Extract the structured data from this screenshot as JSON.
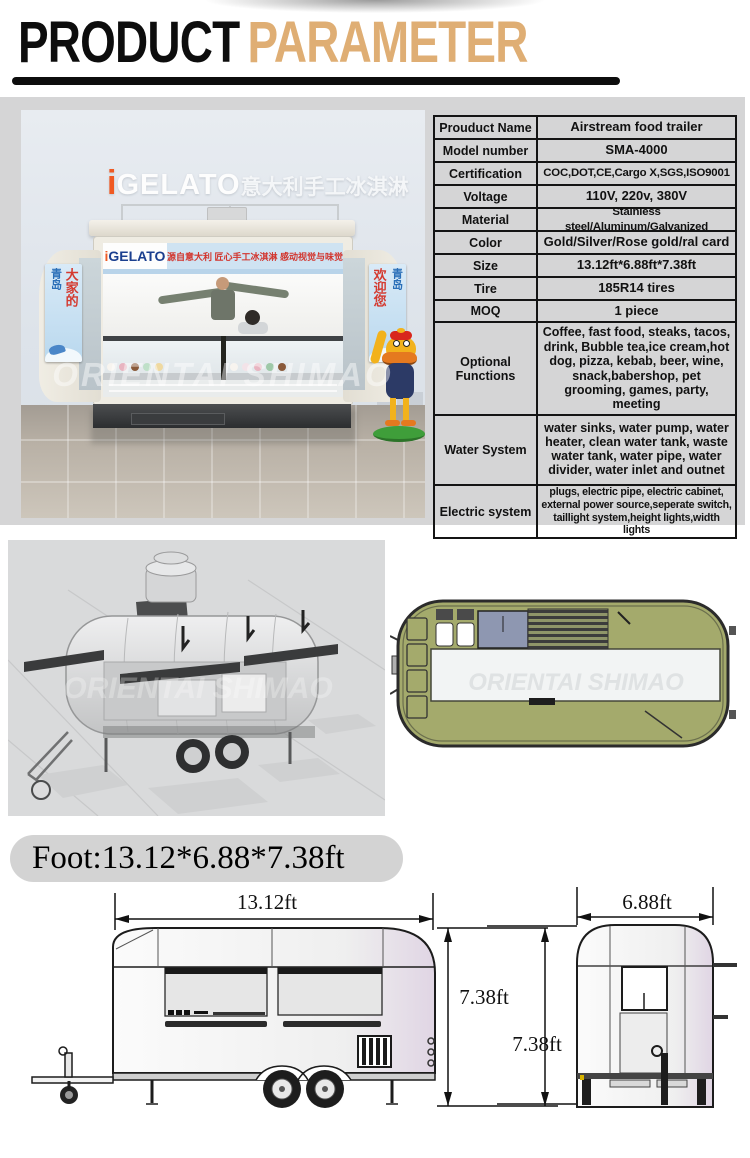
{
  "header": {
    "title_black": "PRODUCT",
    "title_accent": "PARAMETER",
    "accent_color": "#dfae74"
  },
  "photo": {
    "rooftop_sign_i": "i",
    "rooftop_sign_brand": "GELATO",
    "rooftop_sign_cn": "意大利手工冰淇淋",
    "banner_brand_i": "i",
    "banner_brand": "GELATO",
    "banner_cn": "源自意大利 匠心手工冰淇淋 感动视觉与味觉",
    "poster_left_blue": "青岛",
    "poster_left_red": "大家的",
    "poster_right_red": "欢迎您",
    "poster_right_blue": "青岛",
    "watermark": "ORIENTAI SHIMAO"
  },
  "spec_table": {
    "rows": [
      {
        "label": "Prouduct Name",
        "value": "Airstream food trailer"
      },
      {
        "label": "Model number",
        "value": "SMA-4000"
      },
      {
        "label": "Certification",
        "value": "COC,DOT,CE,Cargo X,SGS,ISO9001"
      },
      {
        "label": "Voltage",
        "value": "110V, 220v, 380V"
      },
      {
        "label": "Material",
        "value": "Stainless steel/Aluminum/Galvanized"
      },
      {
        "label": "Color",
        "value": "Gold/Silver/Rose gold/ral card"
      },
      {
        "label": "Size",
        "value": "13.12ft*6.88ft*7.38ft"
      },
      {
        "label": "Tire",
        "value": "185R14 tires"
      },
      {
        "label": "MOQ",
        "value": "1 piece"
      },
      {
        "label": "Optional Functions",
        "value": "Coffee, fast food, steaks, tacos, drink, Bubble tea,ice cream,hot dog, pizza, kebab, beer, wine, snack,babershop, pet grooming, games, party, meeting"
      },
      {
        "label": "Water System",
        "value": "water sinks, water pump, water heater, clean water tank, waste water tank, water pipe, water divider, water inlet and outnet"
      },
      {
        "label": "Electric system",
        "value": "plugs, electric pipe, electric cabinet, external power source,seperate switch, taillight system,height lights,width lights"
      }
    ]
  },
  "drawings": {
    "watermark_3d": "ORIENTAI SHIMAO",
    "watermark_plan": "ORIENTAI SHIMAO"
  },
  "footprint": {
    "label": "Foot:13.12*6.88*7.38ft",
    "dim_length": "13.12ft",
    "dim_height_side": "7.38ft",
    "dim_height_rear": "7.38ft",
    "dim_width": "6.88ft"
  }
}
